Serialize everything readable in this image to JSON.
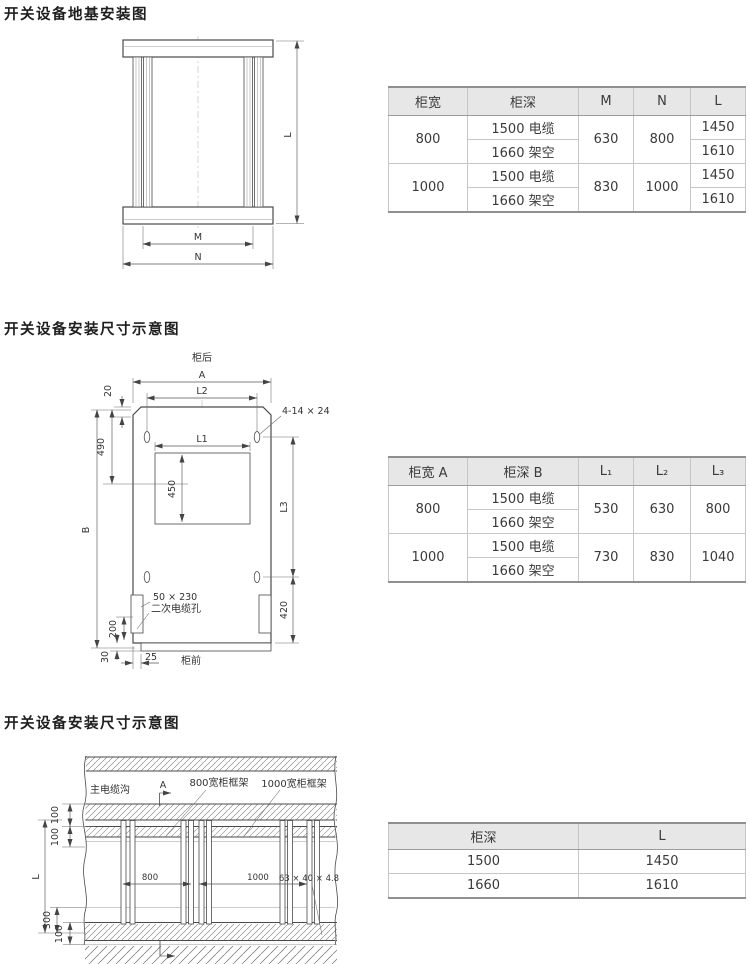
{
  "titles": [
    "开关设备地基安装图",
    "开关设备安装尺寸示意图",
    "开关设备安装尺寸示意图"
  ],
  "diagram1": {
    "dim_l": "L",
    "dim_m": "M",
    "dim_n": "N"
  },
  "diagram2": {
    "rear": "柜后",
    "front": "柜前",
    "dim_a": "A",
    "dim_l2": "L2",
    "dim_l1": "L1",
    "dim_l3": "L3",
    "dim_b": "B",
    "dim_20": "20",
    "dim_490": "490",
    "dim_450": "450",
    "dim_420": "420",
    "dim_200": "200",
    "dim_30": "30",
    "dim_25": "25",
    "holes_label": "4-14 × 24",
    "slot_size": "50 × 230",
    "slot_name": "二次电缆孔"
  },
  "diagram3": {
    "trench": "主电缆沟",
    "section_a": "A",
    "frame_800": "800宽柜框架",
    "frame_1000": "1000宽柜框架",
    "dim_l": "L",
    "dim_800": "800",
    "dim_1000": "1000",
    "angle_spec": "63 × 40 × 4.8",
    "dim_100_top1": "100",
    "dim_100_top2": "100",
    "dim_300": "300",
    "dim_100_bottom": "100"
  },
  "table1": {
    "headers": [
      "柜宽",
      "柜深",
      "M",
      "N",
      "L"
    ],
    "groups": [
      {
        "width": "800",
        "depths": [
          "1500 电缆",
          "1660 架空"
        ],
        "m": "630",
        "n": "800",
        "l": [
          "1450",
          "1610"
        ]
      },
      {
        "width": "1000",
        "depths": [
          "1500 电缆",
          "1660 架空"
        ],
        "m": "830",
        "n": "1000",
        "l": [
          "1450",
          "1610"
        ]
      }
    ]
  },
  "table2": {
    "headers": [
      "柜宽 A",
      "柜深 B",
      "L₁",
      "L₂",
      "L₃"
    ],
    "groups": [
      {
        "width": "800",
        "depths": [
          "1500 电缆",
          "1660 架空"
        ],
        "l1": "530",
        "l2": "630",
        "l3": "800"
      },
      {
        "width": "1000",
        "depths": [
          "1500 电缆",
          "1660 架空"
        ],
        "l1": "730",
        "l2": "830",
        "l3": "1040"
      }
    ]
  },
  "table3": {
    "headers": [
      "柜深",
      "L"
    ],
    "rows": [
      [
        "1500",
        "1450"
      ],
      [
        "1660",
        "1610"
      ]
    ]
  },
  "colors": {
    "header_bg": "#e7e7e7",
    "border_dark": "#8f8f8f",
    "border_light": "#c6c6c6",
    "line": "#4a4a4a",
    "text": "#3a3a3a"
  }
}
